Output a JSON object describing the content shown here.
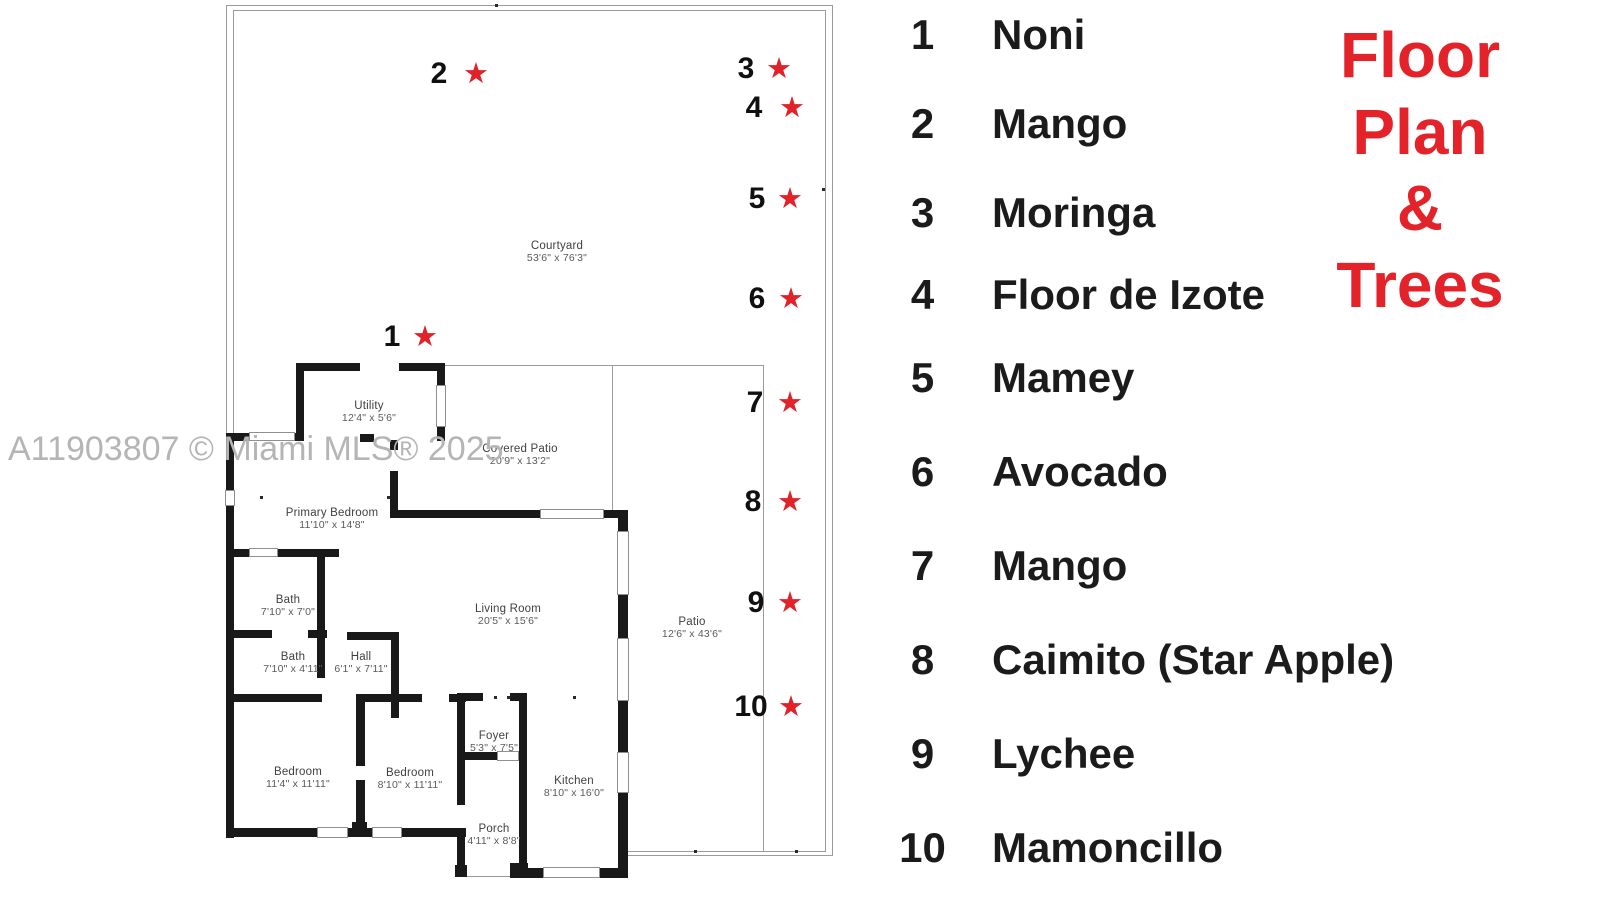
{
  "watermark": "A11903807 © Miami MLS® 2025",
  "title": {
    "lines": [
      "Floor",
      "Plan",
      "&",
      "Trees"
    ],
    "color": "#e32329"
  },
  "legend": {
    "items": [
      {
        "num": "1",
        "name": "Noni"
      },
      {
        "num": "2",
        "name": "Mango"
      },
      {
        "num": "3",
        "name": "Moringa"
      },
      {
        "num": "4",
        "name": "Floor de Izote"
      },
      {
        "num": "5",
        "name": "Mamey"
      },
      {
        "num": "6",
        "name": "Avocado"
      },
      {
        "num": "7",
        "name": "Mango"
      },
      {
        "num": "8",
        "name": "Caimito (Star Apple)"
      },
      {
        "num": "9",
        "name": "Lychee"
      },
      {
        "num": "10",
        "name": "Mamoncillo"
      }
    ]
  },
  "plan": {
    "star_color": "#e02229",
    "star_icon": "★",
    "rooms": [
      {
        "name": "Courtyard",
        "dims": "53'6\" x 76'3\""
      },
      {
        "name": "Utility",
        "dims": "12'4\" x 5'6\""
      },
      {
        "name": "Covered Patio",
        "dims": "20'9\" x 13'2\""
      },
      {
        "name": "Primary Bedroom",
        "dims": "11'10\" x 14'8\""
      },
      {
        "name": "Bath",
        "dims": "7'10\" x 7'0\""
      },
      {
        "name": "Living Room",
        "dims": "20'5\" x 15'6\""
      },
      {
        "name": "Patio",
        "dims": "12'6\" x 43'6\""
      },
      {
        "name": "Bath",
        "dims": "7'10\" x 4'11\""
      },
      {
        "name": "Hall",
        "dims": "6'1\" x 7'11\""
      },
      {
        "name": "Foyer",
        "dims": "5'3\" x 7'5\""
      },
      {
        "name": "Bedroom",
        "dims": "11'4\" x 11'11\""
      },
      {
        "name": "Bedroom",
        "dims": "8'10\" x 11'11\""
      },
      {
        "name": "Kitchen",
        "dims": "8'10\" x 16'0\""
      },
      {
        "name": "Porch",
        "dims": "4'11\" x 8'8\""
      }
    ],
    "markers": [
      {
        "num": "1"
      },
      {
        "num": "2"
      },
      {
        "num": "3"
      },
      {
        "num": "4"
      },
      {
        "num": "5"
      },
      {
        "num": "6"
      },
      {
        "num": "7"
      },
      {
        "num": "8"
      },
      {
        "num": "9"
      },
      {
        "num": "10"
      }
    ]
  }
}
